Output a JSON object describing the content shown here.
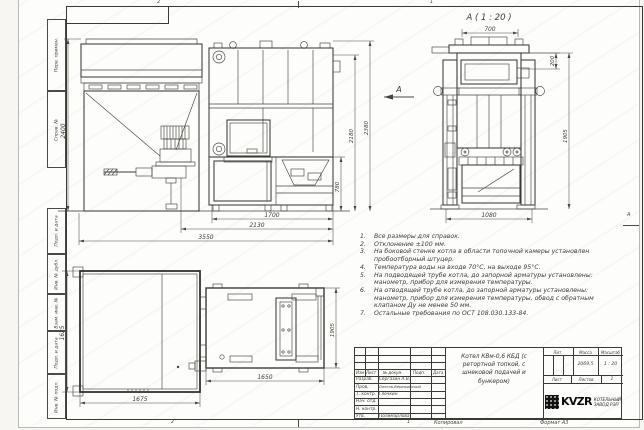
{
  "sheet": {
    "zone_top_left": "2",
    "zone_top_right": "1",
    "zone_bottom_left": "2",
    "zone_bottom_right": "1",
    "zone_right": "А",
    "side_labels": [
      "Перв. примен.",
      "Справ. №",
      "Подп. и дата",
      "Инв. № дубл.",
      "Взам. инв. №",
      "Подп. и дата",
      "Инв. № подл."
    ]
  },
  "views": {
    "detail_title": "А ( 1 : 20 )",
    "section_arrow": "А",
    "dims": {
      "h2400": "2400",
      "w3550": "3550",
      "w2130": "2130",
      "w1700": "1700",
      "h780": "780",
      "h2180": "2180",
      "h2380": "2380",
      "w700": "700",
      "h200": "200",
      "h1905": "1905",
      "w1080": "1080",
      "h1625": "1625",
      "w1675": "1675",
      "w1650": "1650",
      "d1905": "1905"
    }
  },
  "notes": [
    {
      "num": "1.",
      "text": "Все размеры для справок."
    },
    {
      "num": "2.",
      "text": "Отклонение ±100 мм."
    },
    {
      "num": "3.",
      "text": "На боковой стенке котла в области топочной камеры установлен пробоотборный штуцер."
    },
    {
      "num": "4.",
      "text": "Температура воды на входе 70°С, на выходе 95°С."
    },
    {
      "num": "5.",
      "text": "На подводящей трубе котла, до запорной арматуры установлены: манометр, прибор для измерения температуры."
    },
    {
      "num": "6.",
      "text": "На отводящей трубе котла, до запорной арматуры установлены: манометр, прибор для измерения температуры, обвод с обратным клапаном Ду не менее 50 мм."
    },
    {
      "num": "7.",
      "text": "Остальные требования по ОСТ 108.030.133-84."
    }
  ],
  "title_block": {
    "cols": {
      "izm": "Изм",
      "list": "Лист",
      "doc": "№ докум.",
      "sign": "Подп.",
      "date": "Дата"
    },
    "rows": [
      {
        "label": "Разраб.",
        "name": "Сергазин А.В."
      },
      {
        "label": "Пров.",
        "name": "Онегов-Вережинский"
      },
      {
        "label": "Т. контр.",
        "name": "Глечкин"
      },
      {
        "label": "Нач. отд.",
        "name": ""
      },
      {
        "label": "Н. контр.",
        "name": ""
      },
      {
        "label": "Утв.",
        "name": "Полимарлова"
      }
    ],
    "doc_title": "Котел КВм-0,6 КБД (с ретортной топкой, с шнековой подачей и бункером)",
    "lit_label": "Лит.",
    "mass_label": "Масса",
    "scale_label": "Масштаб",
    "mass": "2069,5",
    "scale": "1 : 20",
    "sheet_label": "Лист",
    "sheets_label": "Листов",
    "sheets_value": "1",
    "logo": "KVZR",
    "org1": "КОТЕЛЬНЫЙ",
    "org2": "ЗАВОД РЭП",
    "copied": "Копировал",
    "format": "Формат А3"
  }
}
